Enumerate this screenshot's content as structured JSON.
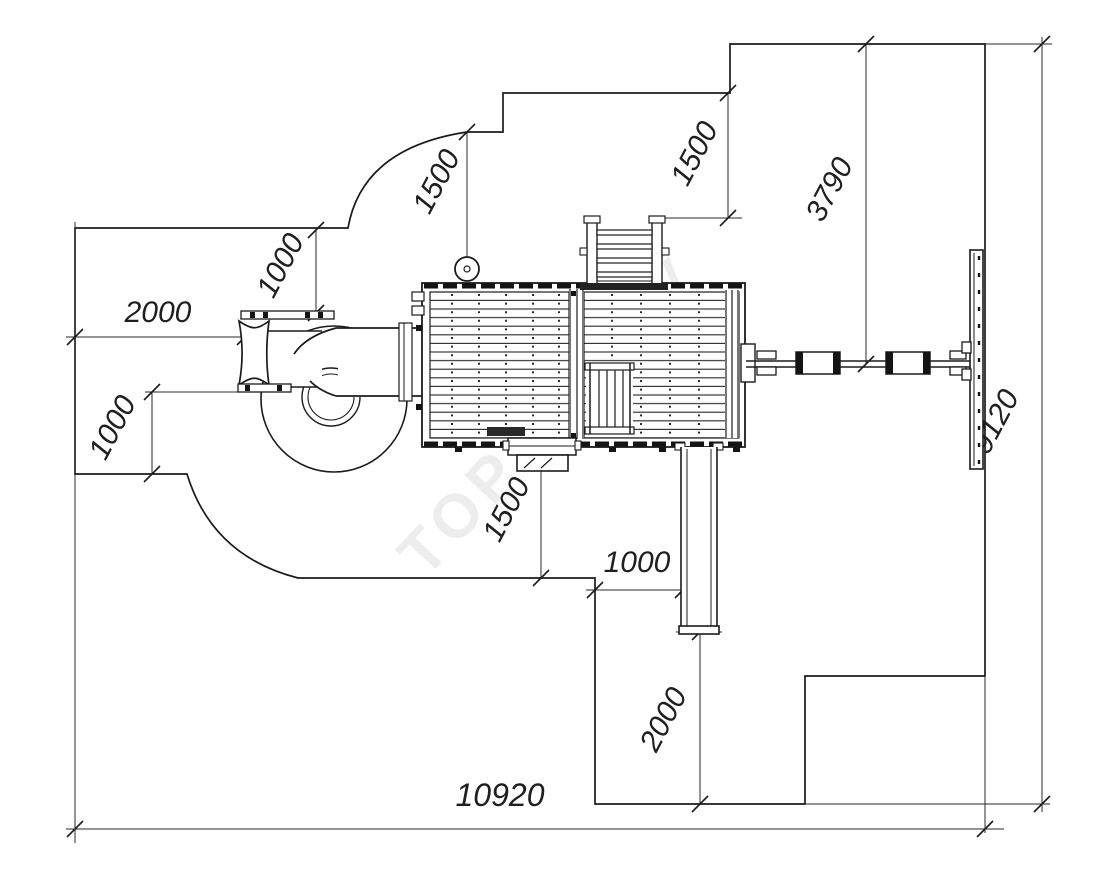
{
  "drawing": {
    "watermark": "ТОРУДА.РУ",
    "dims": {
      "left_width": "2000",
      "top_left_offset": "1000",
      "wheel_clearance": "1500",
      "ladder_clearance": "1500",
      "beam_span": "3790",
      "zone_height": "9120",
      "bottom_left_offset": "1000",
      "step_clearance": "1500",
      "slide_offset": "1000",
      "slide_runout": "2000",
      "zone_width": "10920"
    }
  }
}
